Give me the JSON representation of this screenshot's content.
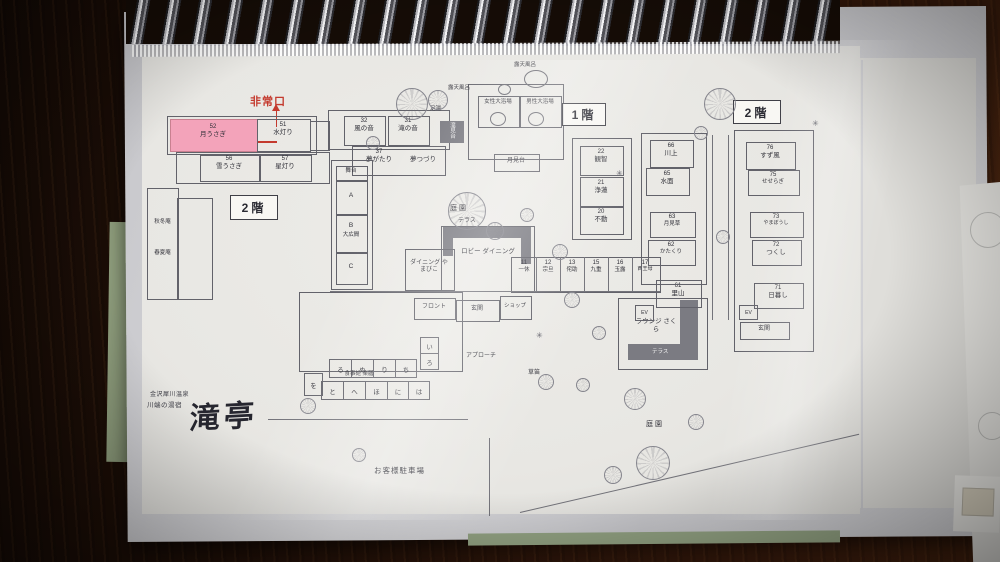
{
  "plan": {
    "badges": {
      "floor2_left": "2階",
      "floor1": "1階",
      "floor2_right": "2階"
    },
    "emergency_exit": "非常口",
    "garden_top": "庭園",
    "garden_se": "庭園",
    "parking": "お客様駐車場",
    "terrace_top": "テラス",
    "terrace_lounge": "テラス",
    "lobby": "ロビー ダイニング",
    "dining_yamabiko": "ダイニング やまびこ",
    "front_desk": "フロント",
    "entrance": "玄関",
    "entrance_annex": "玄関",
    "shop": "ショップ",
    "approach": "アプローチ",
    "kusabue": "草笛",
    "dining_hall": "食事処 楽膳",
    "lounge": "ラウンジ さくら",
    "stage": "舞台",
    "hall_a": "A",
    "hall_b": "B",
    "hall_b_name": "大広間",
    "hall_c": "C",
    "foot_bath": "足湯",
    "taki_midai": "滝見台",
    "tsuki_midai": "月見台",
    "rotenburo_left": "露天風呂",
    "rotenburo_right": "露天風呂",
    "bath_women": "女性大浴場",
    "bath_men": "男性大浴場",
    "ev": "EV",
    "ev2": "EV",
    "annex_left": {
      "shutoan": "秋冬庵",
      "shunkaan": "春夏庵"
    },
    "rooms": {
      "tsukiusagi": {
        "num": "52",
        "name": "月うさぎ"
      },
      "mizuakari": {
        "num": "51",
        "name": "水灯り"
      },
      "yukiusagi": {
        "num": "56",
        "name": "雪うさぎ"
      },
      "hoshiakari": {
        "num": "57",
        "name": "星灯り"
      },
      "kazenooto": {
        "num": "32",
        "name": "風の音"
      },
      "takinooto": {
        "num": "31",
        "name": "滝の音"
      },
      "yumegatari": {
        "num": "37",
        "name": "夢がたり"
      },
      "yumetsuzuri": {
        "num": "",
        "name": "夢つづり"
      },
      "kanchi": {
        "num": "22",
        "name": "観智"
      },
      "joren": {
        "num": "21",
        "name": "浄蓮"
      },
      "fudo": {
        "num": "20",
        "name": "不動"
      },
      "ikkyu": {
        "num": "11",
        "name": "一休"
      },
      "sotan": {
        "num": "12",
        "name": "宗旦"
      },
      "wabisuke": {
        "num": "13",
        "name": "侘助"
      },
      "kokonoe": {
        "num": "15",
        "name": "九重"
      },
      "gyokuro": {
        "num": "16",
        "name": "玉露"
      },
      "seiobo": {
        "num": "17",
        "name": "西王母"
      },
      "kawakami": {
        "num": "66",
        "name": "川上"
      },
      "minamo": {
        "num": "65",
        "name": "水面"
      },
      "tsukimiso": {
        "num": "63",
        "name": "月見草"
      },
      "katakuri": {
        "num": "62",
        "name": "かたくり"
      },
      "satoyama": {
        "num": "61",
        "name": "里山"
      },
      "suzukaze": {
        "num": "76",
        "name": "すず風"
      },
      "seseragi": {
        "num": "75",
        "name": "せせらぎ"
      },
      "yamaboshi": {
        "num": "73",
        "name": "やまぼうし"
      },
      "tsukushi": {
        "num": "72",
        "name": "つくし"
      },
      "higurashi": {
        "num": "71",
        "name": "日暮し"
      }
    },
    "iroha": {
      "i": "い",
      "ro": "ろ",
      "ru": "る",
      "nu": "ぬ",
      "ri": "り",
      "chi": "ち",
      "wo": "を",
      "to": "と",
      "he": "へ",
      "ho": "ほ",
      "ni": "に",
      "ha": "は"
    },
    "logo": {
      "sub1": "金沢犀川温泉",
      "sub2": "川端の湯宿",
      "name": "滝亭"
    },
    "icons": {
      "shrub": "✳"
    },
    "colors": {
      "highlight_pink": "#f3a3ba",
      "emergency_red": "#c43a2e",
      "plan_line": "#62626a",
      "dark_fill": "#7b7b82"
    }
  }
}
